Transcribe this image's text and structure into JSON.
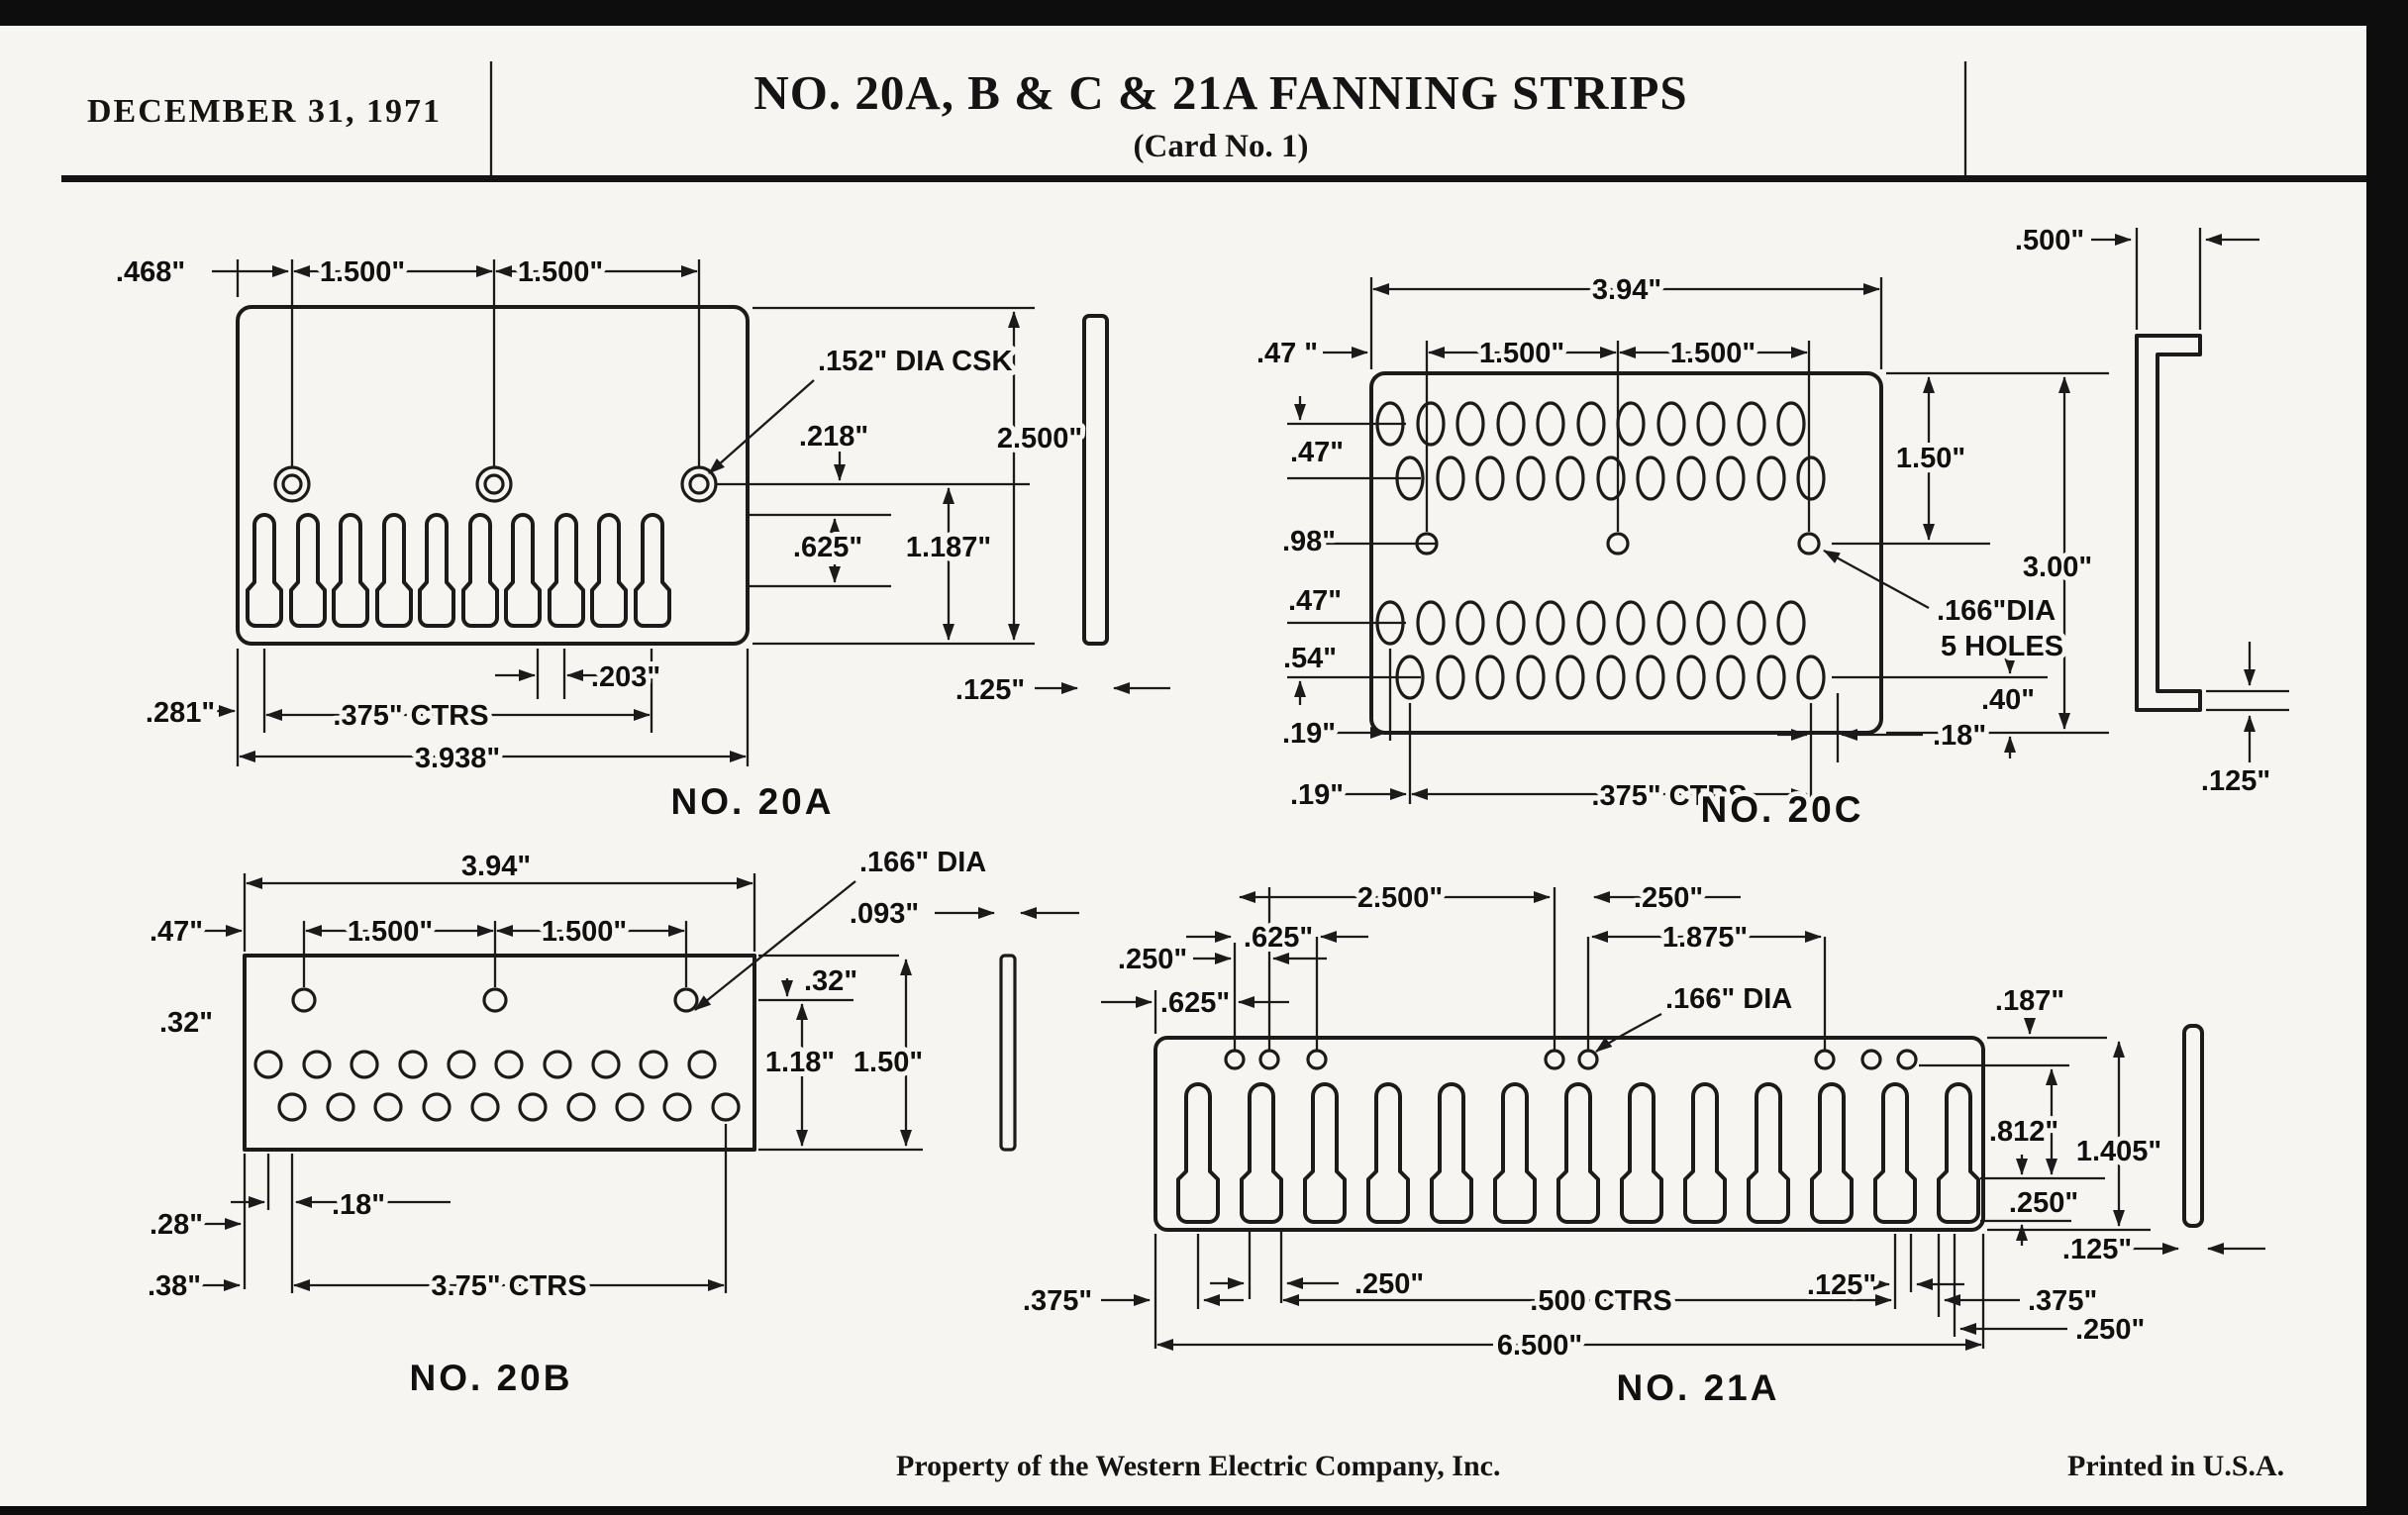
{
  "header": {
    "date": "DECEMBER 31, 1971",
    "title": "NO. 20A, B & C & 21A FANNING STRIPS",
    "subtitle": "(Card No. 1)"
  },
  "footer": {
    "left": "Property of the Western Electric Company, Inc.",
    "right": "Printed in U.S.A."
  },
  "no20a": {
    "name": "NO. 20A",
    "left_offset": ".468\"",
    "pitch1": "1.500\"",
    "pitch2": "1.500\"",
    "csk": ".152\" DIA CSK",
    "hole_drop": ".218\"",
    "height": "2.500\"",
    "slot_depth": ".625\"",
    "comb_depth": "1.187\"",
    "slot_gap": ".203\"",
    "edge_margin": ".281\"",
    "ctrs": ".375\" CTRS",
    "width": "3.938\"",
    "thickness": ".125\""
  },
  "no20b": {
    "name": "NO. 20B",
    "width": "3.94\"",
    "left_margin": ".47\"",
    "pitch1": "1.500\"",
    "pitch2": "1.500\"",
    "dia": ".166\" DIA",
    "thickness": ".093\"",
    "top_offset": ".32\"",
    "row_offset": ".32\"",
    "inner_height": "1.18\"",
    "height": "1.50\"",
    "b28": ".28\"",
    "b18": ".18\"",
    "b38": ".38\"",
    "ctrs": "3.75\" CTRS"
  },
  "no20c": {
    "name": "NO. 20C",
    "width": "3.94\"",
    "left_margin": ".47 \"",
    "pitch1": "1.500\"",
    "pitch2": "1.500\"",
    "flange": ".500\"",
    "row1": ".47\"",
    "row2": ".98\"",
    "row3": ".47\"",
    "row4": ".54\"",
    "col1": ".19\"",
    "col2": ".19\"",
    "upper_height": "1.50\"",
    "height": "3.00\"",
    "dia1": ".166\"DIA",
    "dia2": "5 HOLES",
    "b40": ".40\"",
    "b18": ".18\"",
    "ctrs": ".375\" CTRS",
    "thickness": ".125\""
  },
  "no21a": {
    "name": "NO. 21A",
    "s2500": "2.500\"",
    "r250": ".250\"",
    "u625": ".625\"",
    "s1875": "1.875\"",
    "l250": ".250\"",
    "l625": ".625\"",
    "dia": ".166\" DIA",
    "c187": ".187\"",
    "s812": ".812\"",
    "height": "1.405\"",
    "t250": ".250\"",
    "bl375": ".375\"",
    "b250": ".250\"",
    "ctrs": ".500 CTRS",
    "b125": ".125\"",
    "br375": ".375\"",
    "br250": ".250\"",
    "thickness": ".125\"",
    "width": "6.500\""
  }
}
